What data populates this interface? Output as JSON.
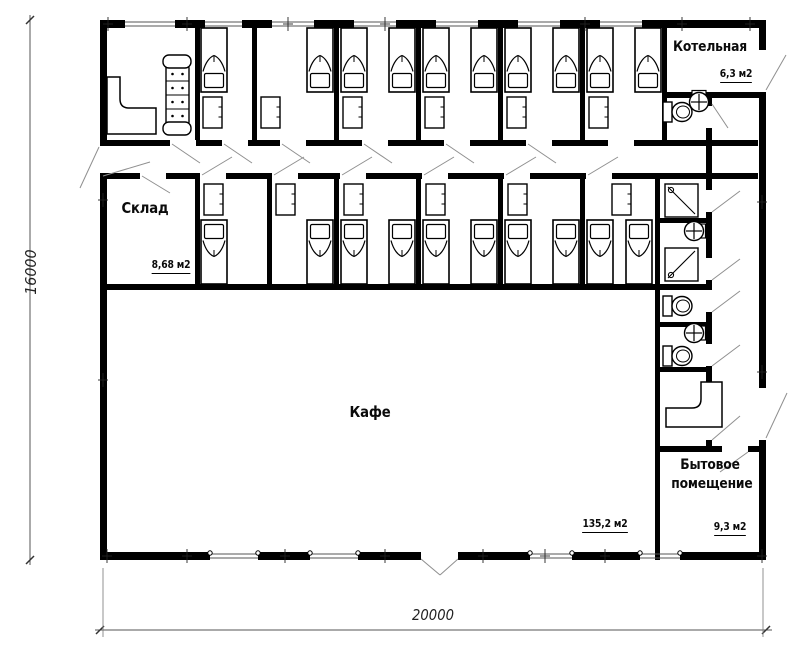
{
  "rooms": {
    "boiler": {
      "label": "Котельная",
      "area": "6,3 м2"
    },
    "warehouse": {
      "label": "Склад",
      "area": "8,68 м2"
    },
    "cafe": {
      "label": "Кафе",
      "area": "135,2 м2"
    },
    "utility": {
      "label": "Бытовое помещение",
      "area": "9,3 м2"
    }
  },
  "dimensions": {
    "left": "16000",
    "bottom": "20000"
  },
  "fixtures": {
    "beds": 20,
    "wardrobes": 12,
    "sofa": 1,
    "desks": 2,
    "showers": 2,
    "toilets": 3,
    "sinks": 3
  },
  "colors": {
    "wall": "#000000",
    "background": "#ffffff",
    "leader": "#8f8f8f",
    "text": "#0b0b0b"
  }
}
